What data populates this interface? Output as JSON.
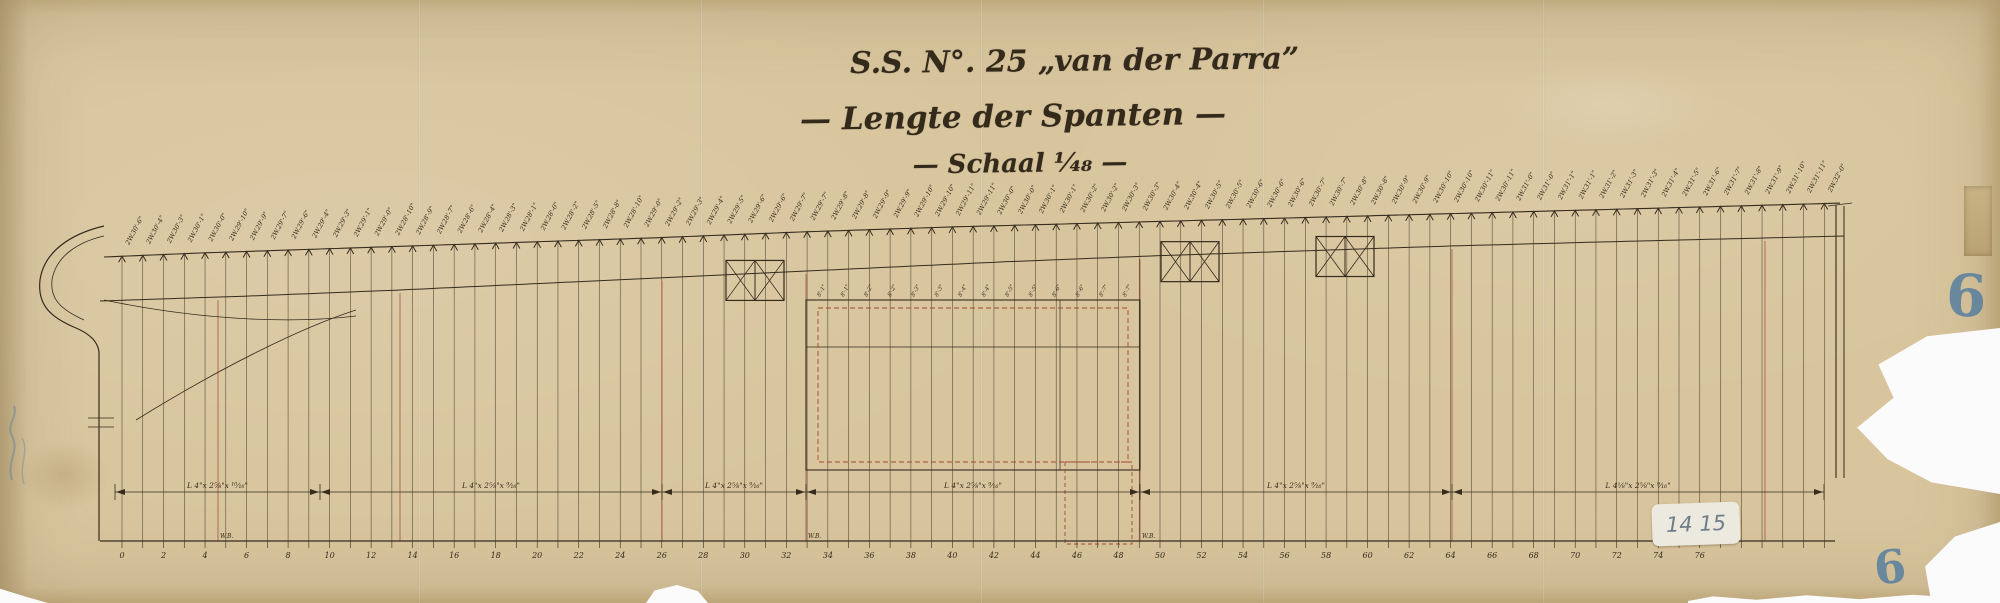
{
  "document": {
    "title_line1": "S.S. N°. 25 „van der Parra”",
    "title_line2": "— Lengte der Spanten —",
    "title_line3": "— Schaal ¹⁄₄₈ —"
  },
  "colors": {
    "paper": "#d8c59d",
    "ink": "#362b1d",
    "red": "#a04a33",
    "blue": "#577f9f",
    "sticker": "#eceadf"
  },
  "frames": {
    "labels": [
      "2W.30'-6\"",
      "2W.30'-4\"",
      "2W.30'-3\"",
      "2W.30'-1\"",
      "2W.30'-0\"",
      "2W.29'-10\"",
      "2W.29'-9\"",
      "2W.29'-7\"",
      "2W.29'-6\"",
      "2W.29'-4\"",
      "2W.29'-3\"",
      "2W.29'-1\"",
      "2W.29'-0\"",
      "2W.28'-10\"",
      "2W.28'-9\"",
      "2W.28'-7\"",
      "2W.28'-6\"",
      "2W.28'-4\"",
      "2W.28'-3\"",
      "2W.28'-1\"",
      "2W.28'-0\"",
      "2W.28'-2\"",
      "2W.28'-5\"",
      "2W.28'-8\"",
      "2W.28'-10\"",
      "2W.29'-0\"",
      "2W.29'-2\"",
      "2W.29'-3\"",
      "2W.29'-4\"",
      "2W.29'-5\"",
      "2W.29'-6\"",
      "2W.29'-6\"",
      "2W.29'-7\"",
      "2W.29'-7\"",
      "2W.29'-8\"",
      "2W.29'-8\"",
      "2W.29'-9\"",
      "2W.29'-9\"",
      "2W.29'-10\"",
      "2W.29'-10\"",
      "2W.29'-11\"",
      "2W.29'-11\"",
      "2W.30'-0\"",
      "2W.30'-0\"",
      "2W.30'-1\"",
      "2W.30'-1\"",
      "2W.30'-2\"",
      "2W.30'-2\"",
      "2W.30'-3\"",
      "2W.30'-3\"",
      "2W.30'-4\"",
      "2W.30'-4\"",
      "2W.30'-5\"",
      "2W.30'-5\"",
      "2W.30'-6\"",
      "2W.30'-6\"",
      "2W.30'-6\"",
      "2W.30'-7\"",
      "2W.30'-7\"",
      "2W.30'-8\"",
      "2W.30'-8\"",
      "2W.30'-9\"",
      "2W.30'-9\"",
      "2W.30'-10\"",
      "2W.30'-10\"",
      "2W.30'-11\"",
      "2W.30'-11\"",
      "2W.31'-0\"",
      "2W.31'-0\"",
      "2W.31'-1\"",
      "2W.31'-1\"",
      "2W.31'-2\"",
      "2W.31'-3\"",
      "2W.31'-3\"",
      "2W.31'-4\"",
      "2W.31'-5\"",
      "2W.31'-6\"",
      "2W.31'-7\"",
      "2W.31'-8\"",
      "2W.31'-9\"",
      "2W.31'-10\"",
      "2W.31'-11\"",
      "2W.32'-0\""
    ]
  },
  "tween_labels": [
    "8'-1\"",
    "8'-1\"",
    "8'-2\"",
    "8'-2\"",
    "8'-3\"",
    "8'-3\"",
    "8'-4\"",
    "8'-4\"",
    "8'-5\"",
    "8'-5\"",
    "8'-6\"",
    "8'-6\"",
    "8'-7\"",
    "8'-7\""
  ],
  "dimension_labels": [
    "L 4\"x 2⅝\"x ¹⁰⁄₁₆\"",
    "L 4\"x 2⅝\"x ⁹⁄₁₆\"",
    "L 4\"x 2⅝\"x ⁹⁄₁₆\"",
    "L 4\"x 2⅝\"x ⁹⁄₁₆\"",
    "L 4\"x 2⅝\"x ⁹⁄₁₆\"",
    "L 4⅛\"x 2⅝\"x ⁹⁄₁₆\""
  ],
  "scale_bar": {
    "numbers": [
      "0",
      "2",
      "4",
      "6",
      "8",
      "10",
      "12",
      "14",
      "16",
      "18",
      "20",
      "22",
      "24",
      "26",
      "28",
      "30",
      "32",
      "34",
      "36",
      "38",
      "40",
      "42",
      "44",
      "46",
      "48",
      "50",
      "52",
      "54",
      "56",
      "58",
      "60",
      "62",
      "64",
      "66",
      "68",
      "70",
      "72",
      "74",
      "76"
    ],
    "wb_labels": [
      "W.B.",
      "W.B.",
      "W.B."
    ]
  },
  "marks": {
    "sticker": "14 15",
    "blue_number_right": "6",
    "blue_number_bottom": "6"
  }
}
